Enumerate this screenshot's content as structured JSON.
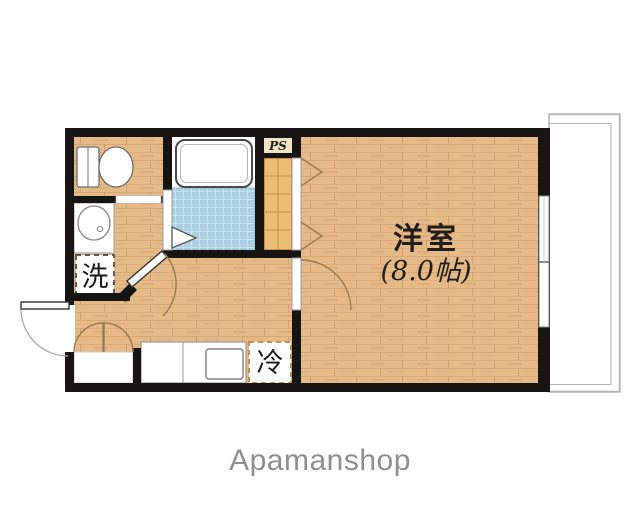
{
  "floorplan": {
    "main_room": {
      "name": "洋室",
      "size": "(8.0帖)"
    },
    "labels": {
      "pipe_space": "PS",
      "washer": "洗",
      "refrigerator": "冷"
    },
    "fixtures": [
      "toilet",
      "wash-basin",
      "bathtub",
      "kitchen-sink",
      "closet",
      "window",
      "balcony",
      "entrance-door"
    ]
  },
  "footer": {
    "brand": "Apamanshop"
  },
  "colors": {
    "wall": "#171513",
    "wood": "#e5ba87",
    "bath_tile": "#abd0e2",
    "closet_fill": "#e9bd72",
    "closet_grid": "#c49145",
    "door_arc": "#9b7b55",
    "balcony_line": "#b5b5b5",
    "fridge_dash": "#c0904e",
    "washer_dash": "#5a5a5a",
    "label_text": "#201d1a",
    "brand_text": "#8f8f8f"
  }
}
